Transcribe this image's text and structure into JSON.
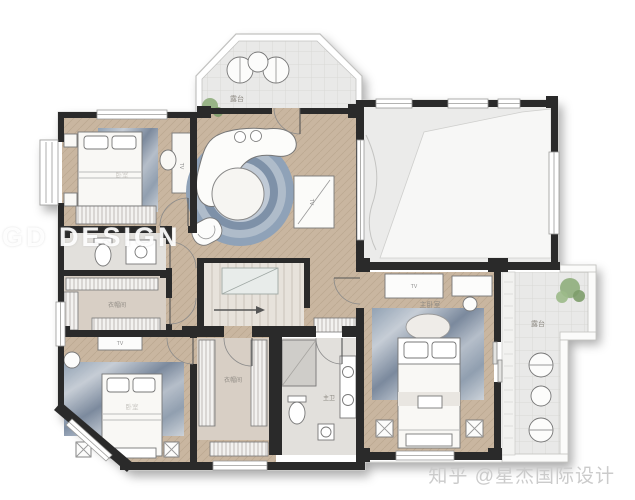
{
  "watermark": {
    "design": "GD DESIGN",
    "zhihu": "知乎 @星杰国际设计"
  },
  "rooms": {
    "balcony_top": {
      "label": "露台"
    },
    "balcony_right": {
      "label": "露台"
    },
    "closet_left": {
      "label": "衣帽间"
    },
    "closet_center": {
      "label": "衣帽间"
    },
    "master_bath": {
      "label": "主卫"
    },
    "master_bedroom": {
      "label": "主卧室"
    },
    "bedroom_top_left": {
      "label": "卧室"
    },
    "bedroom_bottom_left": {
      "label": "卧室"
    }
  },
  "furniture": {
    "tv_label": "TV"
  },
  "colors": {
    "wall": "#2a2a2a",
    "wood_floor": "#c9b6a0",
    "closet_floor": "#d8cfc5",
    "bath_floor": "#e2e0dc",
    "balcony_tile": "#e9e9e8",
    "rug_marble": "#8da0b5",
    "plant_green": "#8fae7c",
    "watermark_gray": "#cbcbcb"
  }
}
